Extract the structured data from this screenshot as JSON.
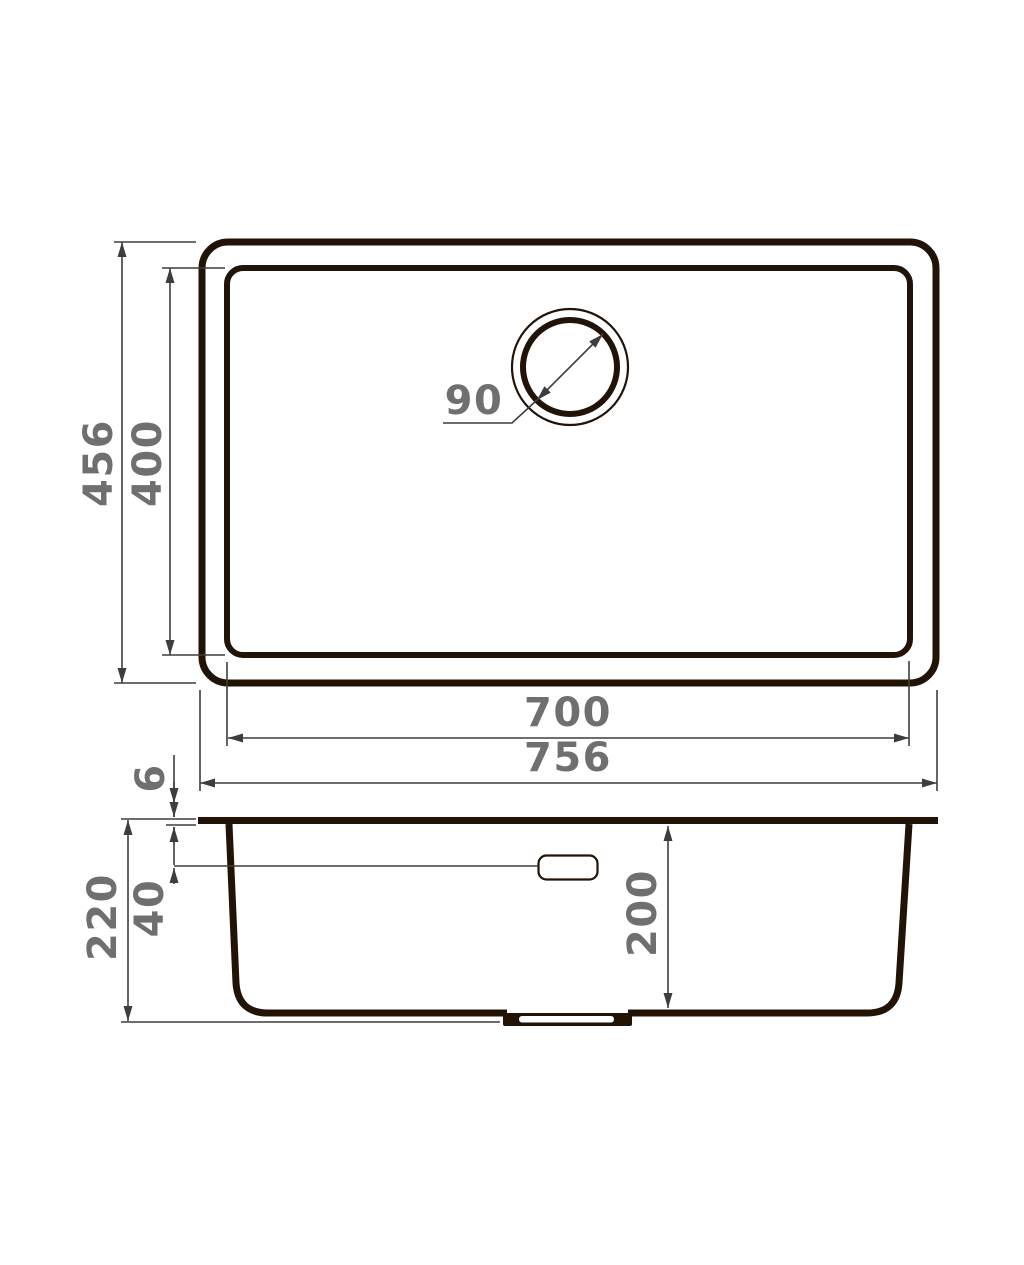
{
  "drawing": {
    "type": "technical-dimension-diagram",
    "subject": "undermount kitchen sink, top view and side section view",
    "units": "mm"
  },
  "views": {
    "top": {
      "outer_width_mm": 756,
      "outer_depth_mm": 456,
      "bowl_width_mm": 700,
      "bowl_depth_mm": 400,
      "drain_diameter_mm": 90
    },
    "side": {
      "total_height_mm": 220,
      "bowl_inner_height_mm": 200,
      "rim_thickness_mm": 6,
      "overflow_offset_mm": 40
    }
  },
  "labels": {
    "outer_depth": "456",
    "bowl_depth": "400",
    "drain_diameter": "90",
    "bowl_width": "700",
    "outer_width": "756",
    "rim_thickness": "6",
    "overflow_offset": "40",
    "total_height": "220",
    "bowl_height": "200"
  },
  "colors": {
    "background": "#ffffff",
    "drawing_line": "#221307",
    "dim_line": "#3d3d3d",
    "label_text": "#6f6f6f"
  }
}
